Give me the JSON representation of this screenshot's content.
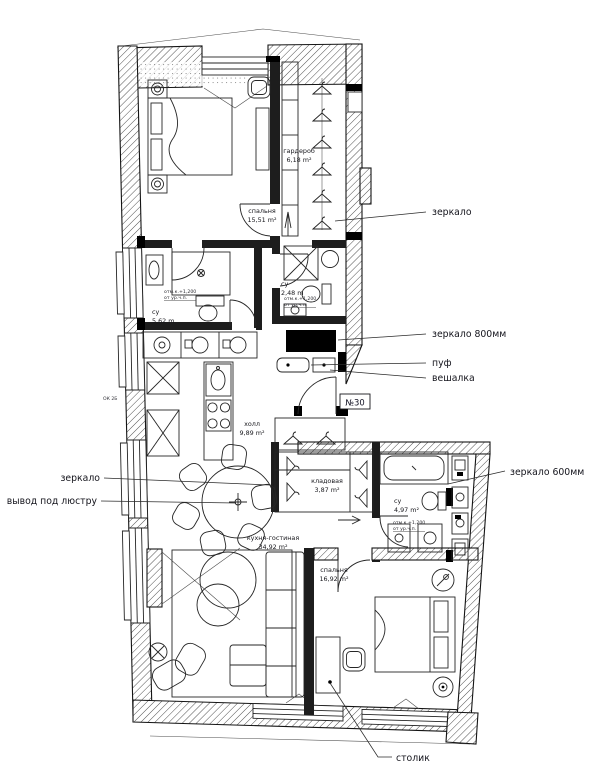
{
  "plan": {
    "unit_label": "№30",
    "window_mark": "ОК 2Б",
    "rooms": {
      "bedroom1": {
        "name": "спальня",
        "area": "15,51 m²"
      },
      "wardrobe": {
        "name": "гардероб",
        "area": "6,18 m²"
      },
      "bath1": {
        "name": "су",
        "area": "5,62 m"
      },
      "bath2": {
        "name": "су",
        "area": "2,48 m"
      },
      "hall": {
        "name": "холл",
        "area": "9,89 m²"
      },
      "storage": {
        "name": "кладовая",
        "area": "3,87 m²"
      },
      "bath3": {
        "name": "су",
        "area": "4,97 m²"
      },
      "living": {
        "name": "кухня-гостиная",
        "area": "34,92 m²"
      },
      "bedroom2": {
        "name": "спальня",
        "area": "16,92 m²"
      }
    },
    "callouts": {
      "mirror_right": "зеркало",
      "mirror_800": "зеркало 800мм",
      "pouf": "пуф",
      "hanger_rack": "вешалка",
      "mirror_600": "зеркало 600мм",
      "mirror_left": "зеркало",
      "chandelier_outlet": "вывод под люстру",
      "side_table": "столик"
    },
    "elevation_note": {
      "line1": "отм.к.+1,200",
      "line2": "от ур.ч.п."
    },
    "colors": {
      "line": "#1d1d1d",
      "paper": "#ffffff"
    }
  }
}
